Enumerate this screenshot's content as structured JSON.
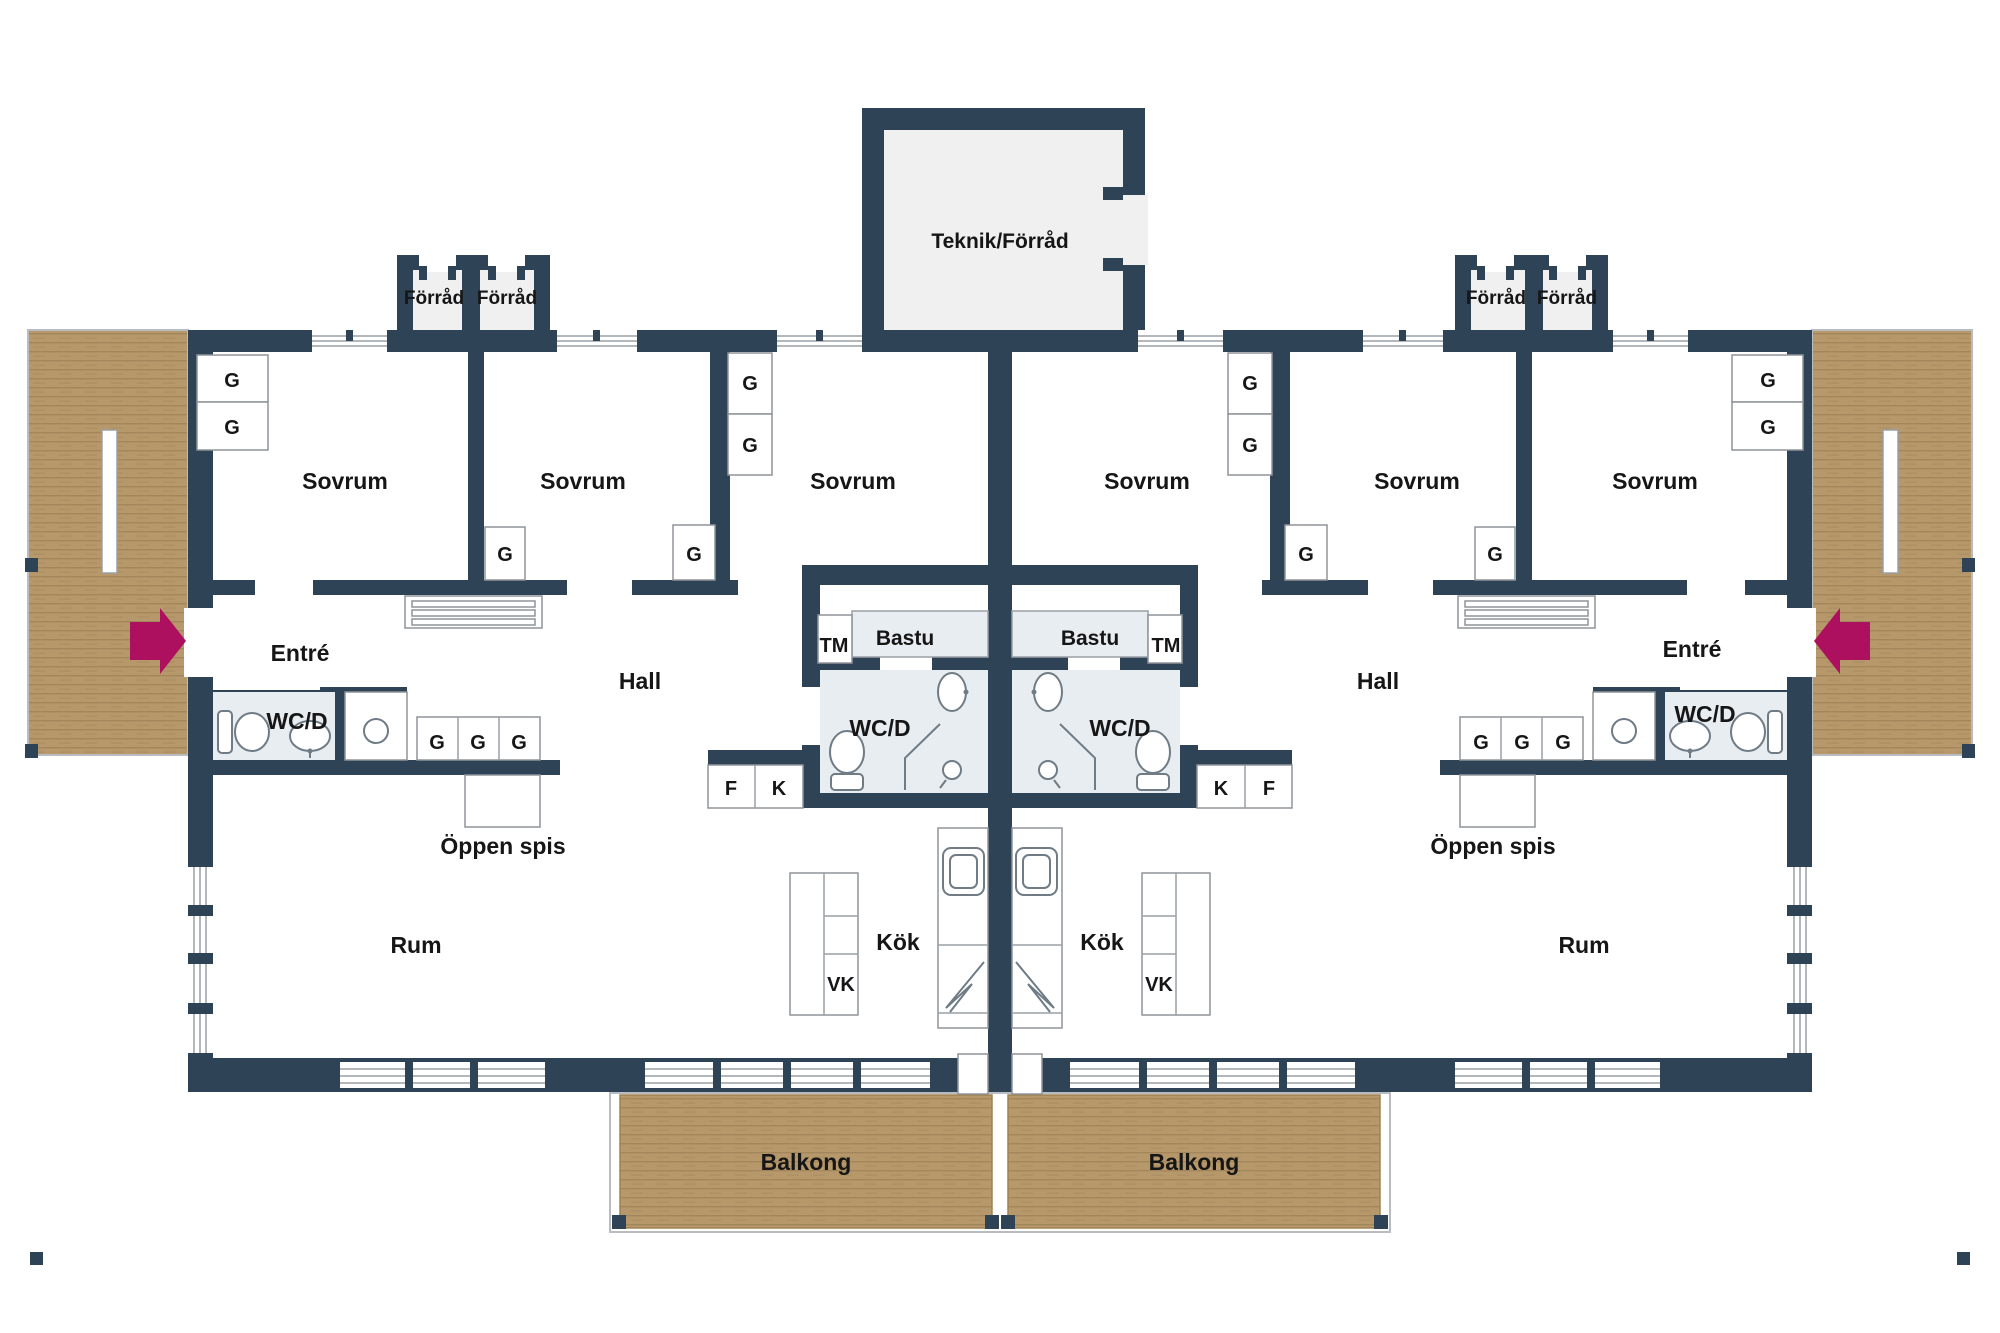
{
  "title": "Floor plan - mirrored duplex dwelling",
  "rooms": {
    "teknik_forrad": "Teknik/Förråd",
    "forrad": "Förråd",
    "sovrum": "Sovrum",
    "entre": "Entré",
    "hall": "Hall",
    "wc_d": "WC/D",
    "bastu": "Bastu",
    "tm": "TM",
    "kok": "Kök",
    "rum": "Rum",
    "balkong": "Balkong",
    "oppen_spis": "Öppen spis"
  },
  "cabinets": {
    "g": "G",
    "vk": "VK",
    "f": "F",
    "k": "K"
  },
  "colors": {
    "wall": "#2e4356",
    "room_fill": "#ffffff",
    "storage_fill": "#f0f0f1",
    "wet_fill": "#e8edf1",
    "wood": "#b6986a",
    "wood_line": "#8f744c",
    "arrow": "#ae1060",
    "text": "#161616",
    "outline": "#8f9499"
  },
  "icons": {
    "entry_arrow": "entry-arrow-icon",
    "toilet": "toilet-icon",
    "sink": "sink-icon",
    "shower": "shower-icon",
    "stove": "stove-icon",
    "kitchen_sink": "kitchen-sink-icon",
    "attic_hatch": "attic-hatch-icon"
  }
}
